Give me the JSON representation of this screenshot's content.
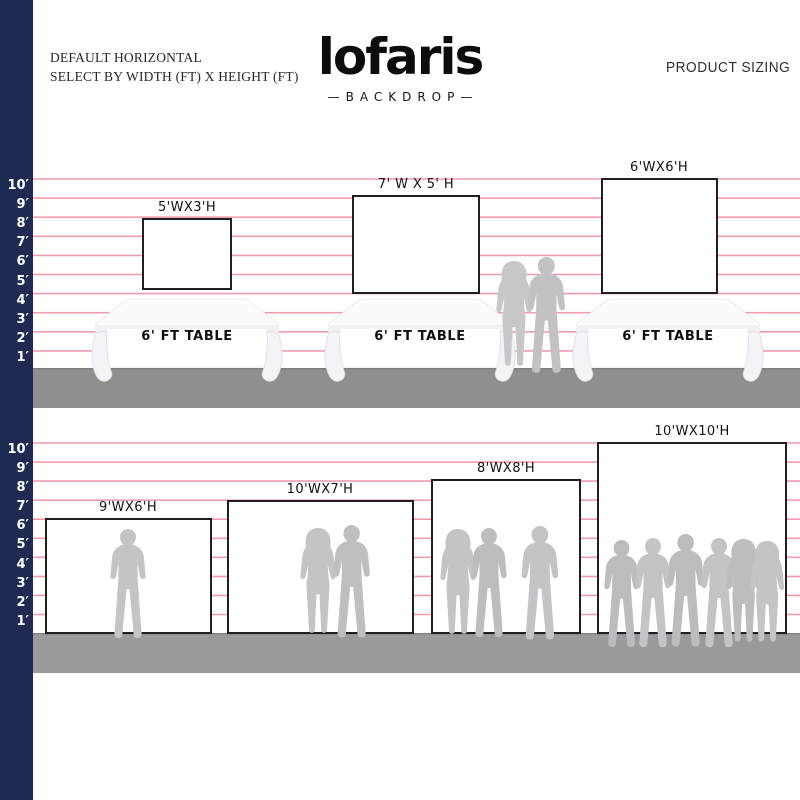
{
  "header": {
    "title_line1": "DEFAULT HORIZONTAL",
    "title_line2": "SELECT BY WIDTH (FT) X HEIGHT (FT)",
    "right_title": "PRODUCT SIZING"
  },
  "brand": {
    "logo": "lofaris",
    "sub": "—BACKDROP—"
  },
  "ruler": {
    "unit": "ft",
    "labels": [
      "10′",
      "9′",
      "8′",
      "7′",
      "6′",
      "5′",
      "4′",
      "3′",
      "2′",
      "1′"
    ]
  },
  "table_label": "6' FT TABLE",
  "backdrops_row1": [
    {
      "label": "5'WX3'H",
      "width_ft": 5,
      "height_ft": 3
    },
    {
      "label": "7' W X 5' H",
      "width_ft": 7,
      "height_ft": 5
    },
    {
      "label": "6'WX6'H",
      "width_ft": 6,
      "height_ft": 6
    }
  ],
  "backdrops_row2": [
    {
      "label": "9'WX6'H",
      "width_ft": 9,
      "height_ft": 6
    },
    {
      "label": "10'WX7'H",
      "width_ft": 10,
      "height_ft": 7
    },
    {
      "label": "8'WX8'H",
      "width_ft": 8,
      "height_ft": 8
    },
    {
      "label": "10'WX10'H",
      "width_ft": 10,
      "height_ft": 10
    }
  ],
  "colors": {
    "navy_bar": "#1e2a52",
    "grid_line_pink": "#f19cab",
    "floor_gray": "#969696",
    "silhouette_gray": "#c4c4c7",
    "backdrop_border": "#1f1f1f"
  }
}
